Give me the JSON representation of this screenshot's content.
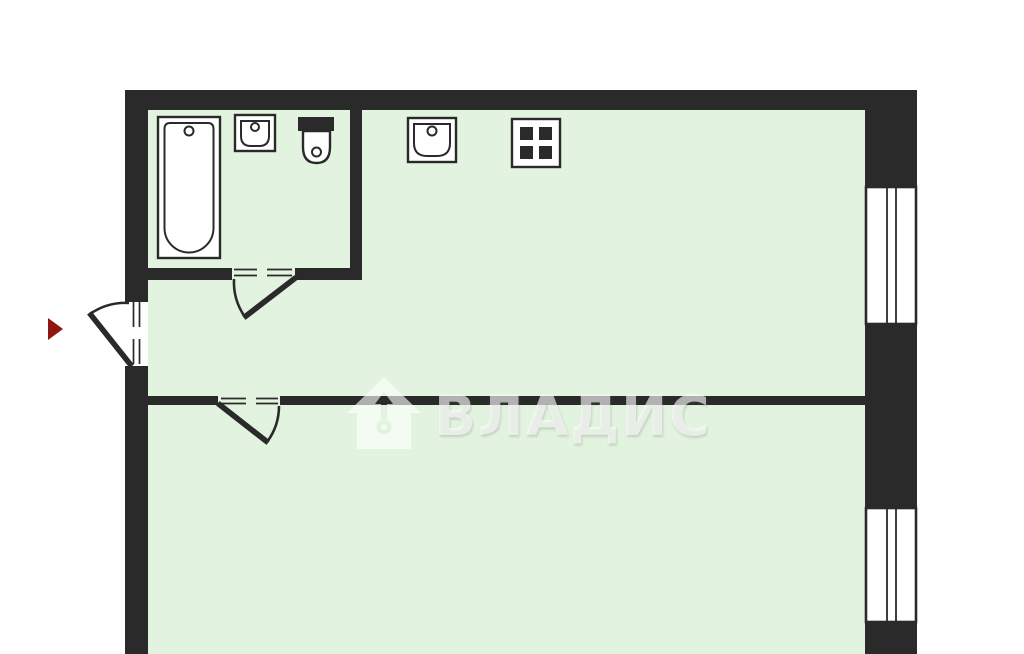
{
  "plan": {
    "type": "apartment-floor-plan",
    "watermark": {
      "text": "ВЛАДИС",
      "logo_icon": "house-key-icon",
      "fill": "rgba(255,255,255,0.62)"
    },
    "entrance_marker": {
      "icon": "entrance-arrow-icon",
      "color": "#8e1712"
    },
    "palette": {
      "wall": "#2a2a2a",
      "floor": "#e2f3df",
      "outside": "#ffffff",
      "fixture_fill": "#ffffff",
      "fixture_stroke": "#2a2a2a"
    },
    "fixtures": {
      "bathroom": [
        "bathtub-icon",
        "sink-icon",
        "toilet-icon"
      ],
      "kitchen": [
        "sink-icon",
        "stove-icon"
      ]
    },
    "features": {
      "windows": 2,
      "door_openings": 3,
      "rooms": 3
    }
  }
}
